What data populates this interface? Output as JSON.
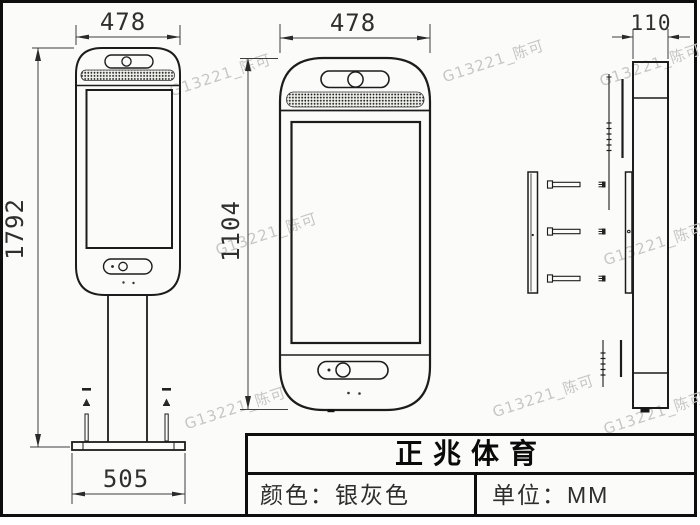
{
  "drawing": {
    "description": "technical drawing of floor-standing face-recognition kiosk, front / unit / side views",
    "bg_color": "#fbfbf9",
    "line_color": "#1c1c1c"
  },
  "dimensions": {
    "front_full_width": "478",
    "front_full_height": "1792",
    "base_width": "505",
    "unit_width": "478",
    "unit_height": "1104",
    "side_depth": "110"
  },
  "title_block": {
    "title": "正兆体育",
    "color_spec": "颜色：银灰色",
    "unit_spec": "单位：MM"
  },
  "watermark": {
    "text": "G13221_陈可"
  }
}
